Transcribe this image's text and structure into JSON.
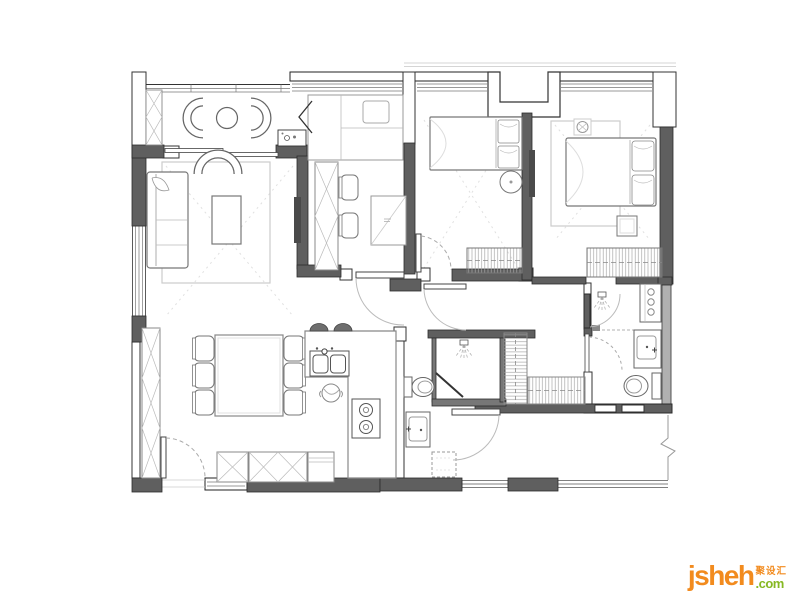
{
  "watermark": {
    "brand": "jsheh",
    "tld": ".com",
    "cjk": "聚设汇",
    "brand_color": "#F28B1E",
    "tld_color": "#86B822"
  },
  "palette": {
    "background": "#ffffff",
    "wall_dark": "#5f5f5f",
    "wall_outline": "#2b2b2b",
    "thin_wall_line": "#333333",
    "furniture_line": "#777777",
    "hatch_line": "#b5b5b5",
    "glazing_line": "#777777",
    "setting_out_dash": "#e0e0e0",
    "rug_line": "#cccccc",
    "tv_fill": "#4a4a4a"
  },
  "floorplan": {
    "type": "apartment-floor-plan",
    "rooms": [
      {
        "id": "balcony",
        "furniture": [
          "lounge-chair",
          "lounge-chair",
          "round-table",
          "storage-cabinet",
          "sliding-door"
        ]
      },
      {
        "id": "living-room",
        "furniture": [
          "sofa",
          "armchair",
          "coffee-table",
          "rug",
          "tv-panel"
        ]
      },
      {
        "id": "study",
        "furniture": [
          "platform-bed",
          "desk-counter",
          "chair",
          "chair",
          "fold-table",
          "mini-bar-sink",
          "folding-door"
        ]
      },
      {
        "id": "bedroom-2",
        "furniture": [
          "single-bed",
          "round-side-table",
          "dresser",
          "door"
        ]
      },
      {
        "id": "master-bedroom",
        "furniture": [
          "double-bed",
          "rug",
          "wardrobe",
          "stool",
          "tv-panel",
          "ceiling-lamp",
          "door"
        ]
      },
      {
        "id": "master-bathroom",
        "furniture": [
          "shower",
          "washer",
          "vanity-sink",
          "toilet",
          "door"
        ]
      },
      {
        "id": "hall-bathroom",
        "furniture": [
          "shower",
          "pivot-door",
          "toilet"
        ]
      },
      {
        "id": "hallway",
        "furniture": [
          "linen-closet",
          "shoe-cabinet",
          "vanity-sink",
          "door"
        ]
      },
      {
        "id": "dining-room",
        "furniture": [
          "dining-table",
          "chair",
          "chair",
          "chair",
          "chair",
          "chair",
          "chair",
          "tall-cabinet",
          "balcony-door"
        ]
      },
      {
        "id": "kitchen",
        "furniture": [
          "island-counter",
          "double-sink",
          "bar-stool",
          "bar-stool",
          "cooktop",
          "pot",
          "base-cabinets"
        ]
      },
      {
        "id": "entry",
        "furniture": [
          "entry-door",
          "shoe-cabinet",
          "window"
        ]
      }
    ]
  }
}
